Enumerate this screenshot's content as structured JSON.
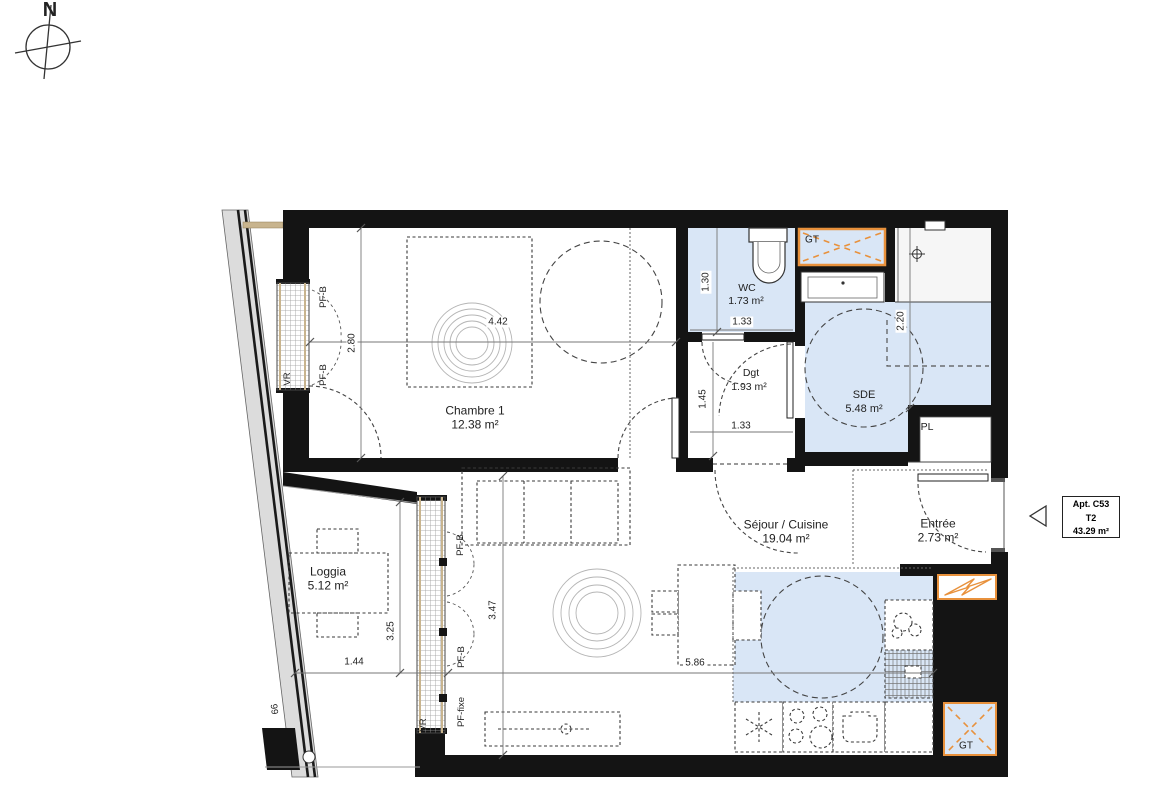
{
  "compass": {
    "north_label": "N"
  },
  "apartment_tag": {
    "line1": "Apt. C53",
    "line2": "T2",
    "line3": "43.29 m²"
  },
  "rooms": {
    "chambre": {
      "name": "Chambre 1",
      "area": "12.38 m²"
    },
    "wc": {
      "name": "WC",
      "area": "1.73 m²"
    },
    "dgt": {
      "name": "Dgt",
      "area": "1.93 m²"
    },
    "sde": {
      "name": "SDE",
      "area": "5.48 m²"
    },
    "sejour": {
      "name": "Séjour / Cuisine",
      "area": "19.04 m²"
    },
    "entree": {
      "name": "Entrée",
      "area": "2.73 m²"
    },
    "loggia": {
      "name": "Loggia",
      "area": "5.12 m²"
    },
    "placard": {
      "name": "PL"
    }
  },
  "dimensions": {
    "chambre_width": "4.42",
    "chambre_height": "2.80",
    "wc_height": "1.30",
    "wc_width": "1.33",
    "dgt_height": "1.45",
    "dgt_width": "1.33",
    "sde_height": "2.20",
    "sejour_height": "3.47",
    "sejour_width": "5.86",
    "loggia_height": "3.25",
    "loggia_width": "1.44",
    "facade_mark": "66"
  },
  "openings": {
    "window_tilting": "PF-B",
    "window_fixed": "PF-fixe",
    "roller_shutter": "VR",
    "duct": "GT"
  },
  "colors": {
    "wet_room_fill": "#d9e6f6",
    "technical_orange": "#e8913c",
    "wall_black": "#141414"
  }
}
